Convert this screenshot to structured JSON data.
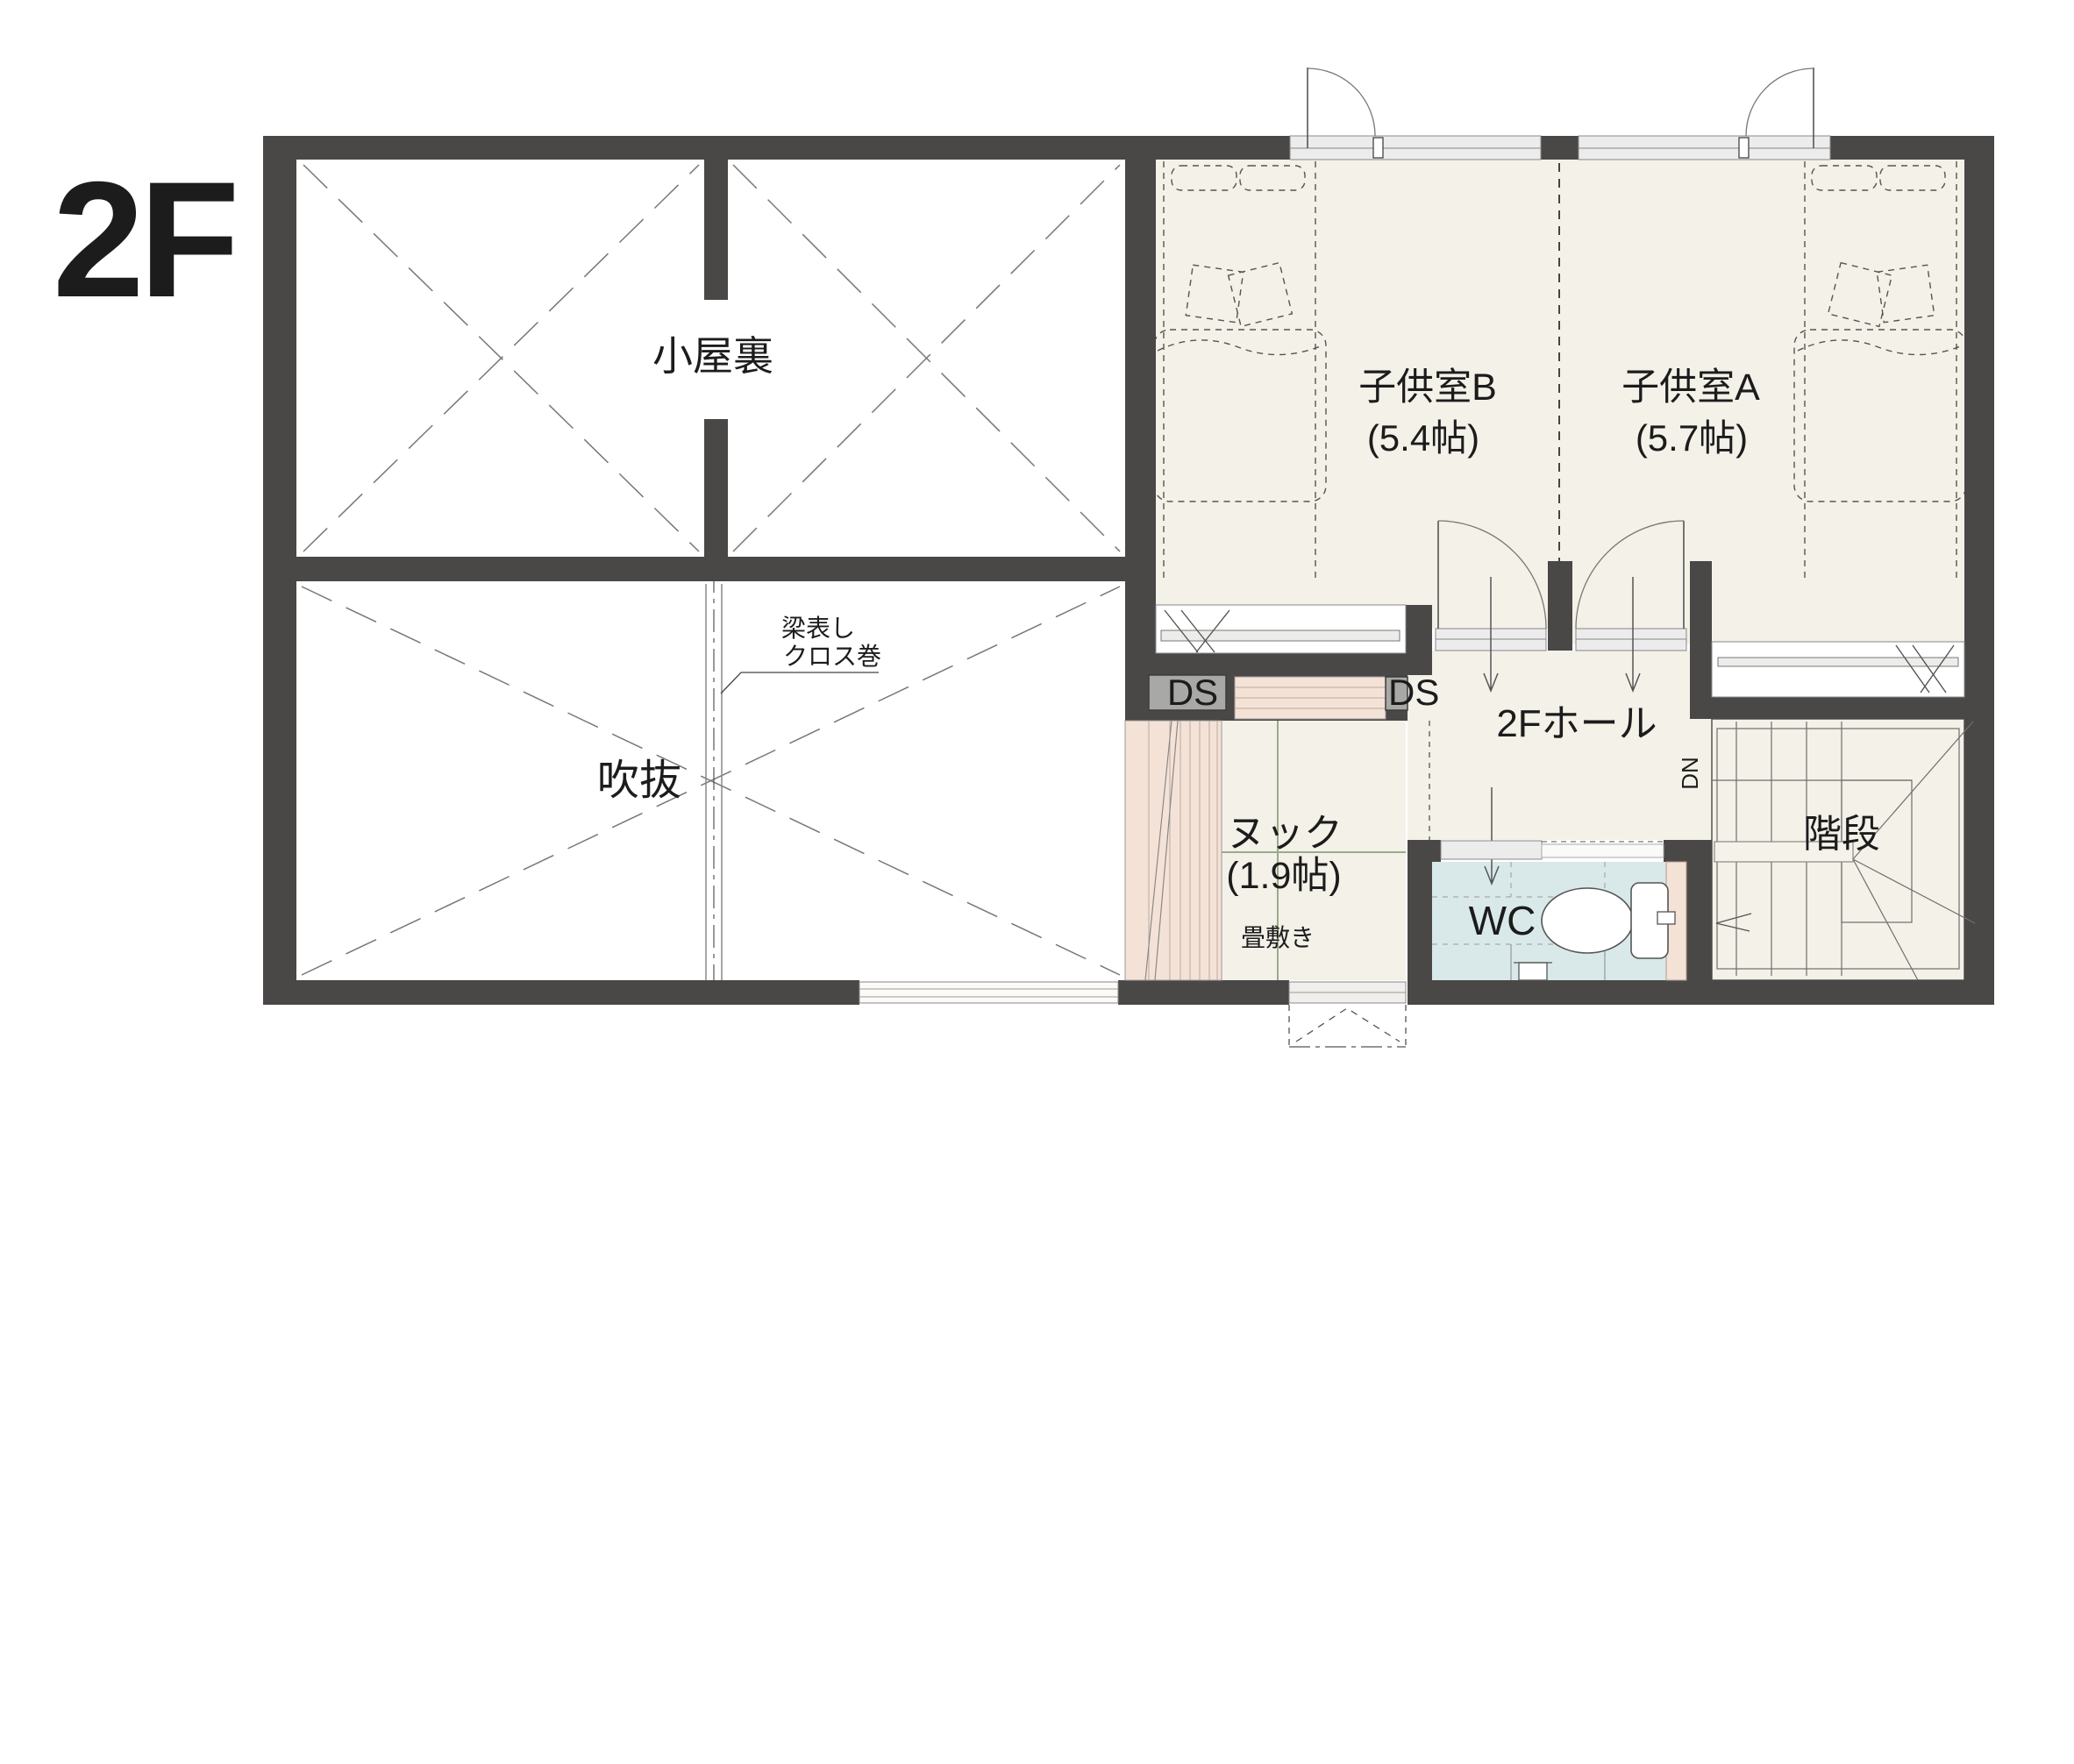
{
  "floor_label": "2F",
  "rooms": {
    "attic": {
      "label": "小屋裏"
    },
    "void": {
      "label": "吹抜",
      "beam_note": [
        "梁表し",
        "クロス巻"
      ]
    },
    "child_room_b": {
      "label": "子供室B",
      "area": "(5.4帖)"
    },
    "child_room_a": {
      "label": "子供室A",
      "area": "(5.7帖)"
    },
    "hall": {
      "label": "2Fホール"
    },
    "nook": {
      "label": "ヌック",
      "area": "(1.9帖)",
      "floor_note": "畳敷き"
    },
    "wc": {
      "label": "WC"
    },
    "stairs": {
      "label": "階段",
      "direction": "DN"
    },
    "duct_space_left": {
      "label": "DS"
    },
    "duct_space_right": {
      "label": "DS"
    }
  },
  "colors": {
    "wall": "#4a4846",
    "floor_cream": "#f3f1e8",
    "wc_blue": "#d9e9ea",
    "peach": "#f5e2d6",
    "ds_gray": "#a8a8a6",
    "tatami_line": "#9aab8b",
    "line_gray": "#6f6f6f",
    "text": "#1c1c1c"
  }
}
